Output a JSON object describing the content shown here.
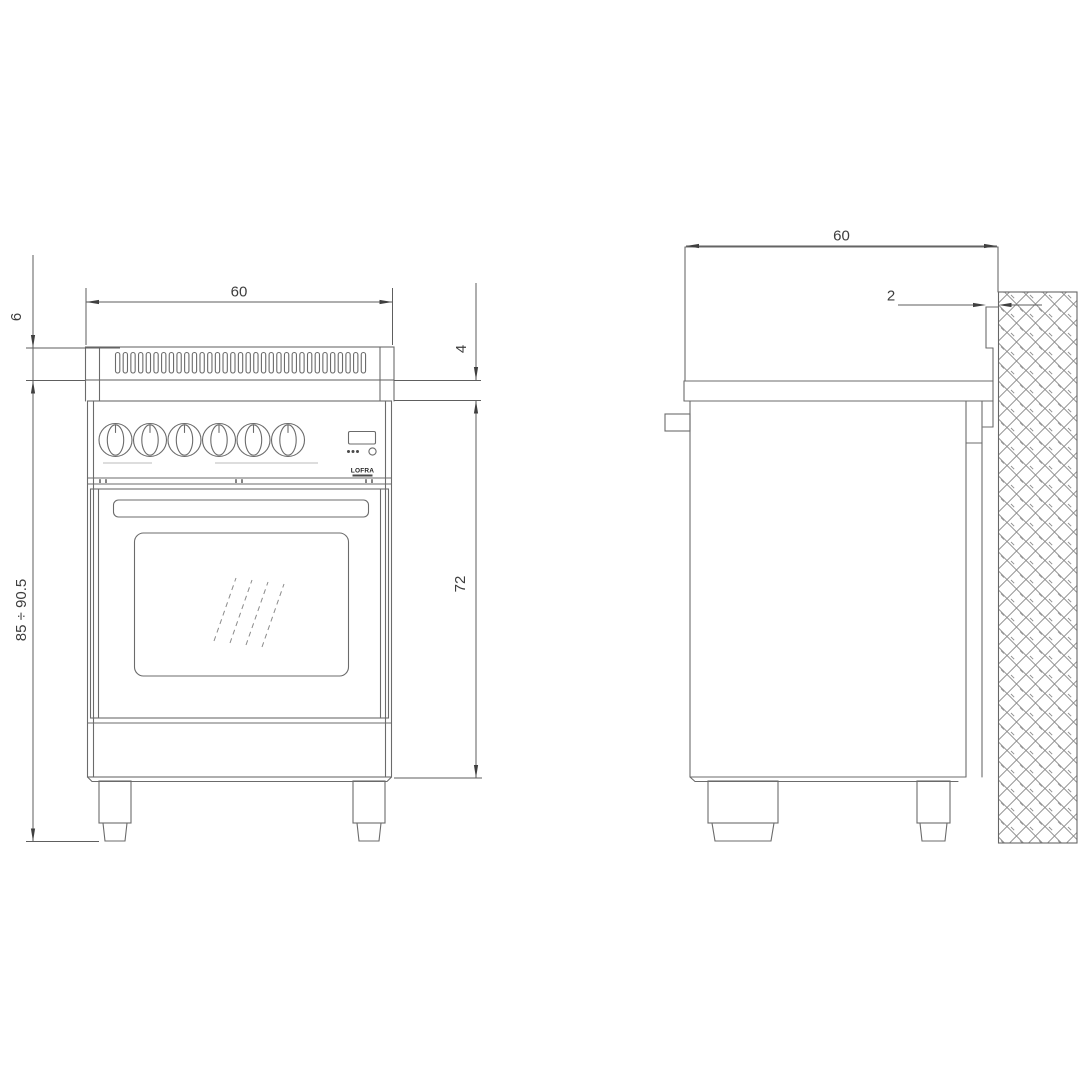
{
  "drawing": {
    "brand": {
      "logo_text": "LOFRA"
    },
    "front_view": {
      "width": "60",
      "backsplash_height": "6",
      "overall_height": "85 ÷ 90.5",
      "top_trim_height": "4",
      "body_height": "72"
    },
    "side_view": {
      "depth": "60",
      "wall_clearance": "2"
    }
  }
}
